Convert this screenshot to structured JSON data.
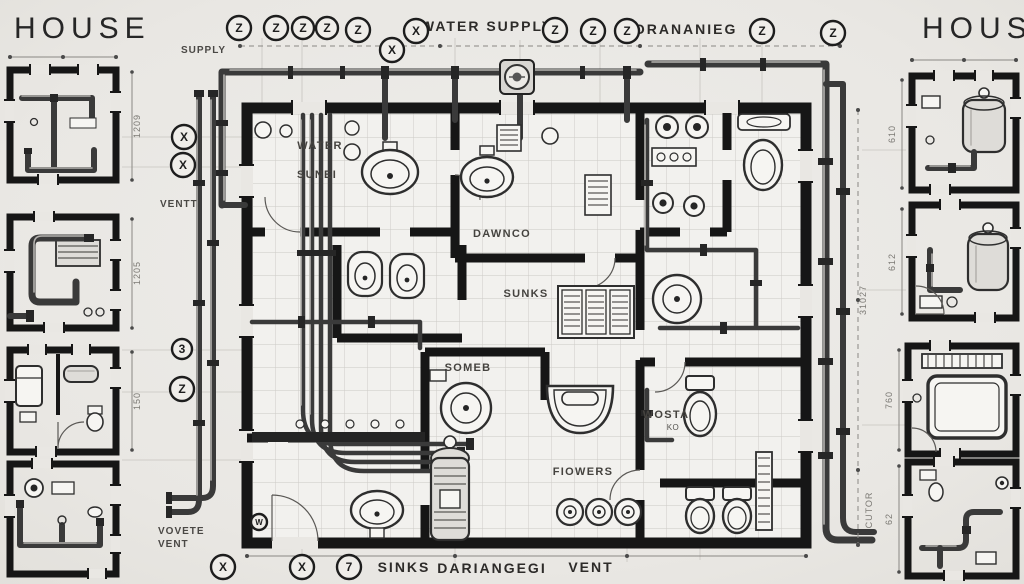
{
  "colors": {
    "paper": "#e9e7e3",
    "ink": "#161616",
    "pipe": "#3a3a3a",
    "grid": "#cbc9c4",
    "dim": "#8a8884"
  },
  "left_panel": {
    "title": "HOUSE",
    "dims": [
      "1209",
      "1205",
      "150"
    ]
  },
  "right_panel": {
    "title": "HOUSE",
    "dims": [
      "610",
      "612",
      "760",
      "62"
    ]
  },
  "main_plan": {
    "top_labels": {
      "supply_small": "SUPPLY",
      "water_supply": "WATER SUPPLY",
      "drainage": "DRANANIEG"
    },
    "left_labels": {
      "vent": "VENTT",
      "vent_bottom_1": "VOVETE",
      "vent_bottom_2": "VENT"
    },
    "bottom_labels": {
      "sinks": "SINKS",
      "drainage": "DARIANGEGI",
      "vent": "VENT"
    },
    "room_labels": {
      "water": "WATER",
      "sunei": "SUNEI",
      "dawnco": "DAWNCO",
      "sunks": "SUNKS",
      "soneb": "SOMEB",
      "flowers": "FIOWERS",
      "wosta": "WOSTA",
      "wosta_sub": "KO"
    },
    "dim_labels": {
      "right_upper": "31027",
      "right_lower": "CUTOR"
    }
  },
  "markers": {
    "top": [
      "Z",
      "Z",
      "Z",
      "Z",
      "Z",
      "X",
      "X",
      "Z",
      "Z",
      "Z",
      "Z",
      "Z"
    ],
    "left": [
      "X",
      "X",
      "3",
      "Z"
    ],
    "bottom": [
      "X",
      "X",
      "7"
    ],
    "shield": "W"
  }
}
